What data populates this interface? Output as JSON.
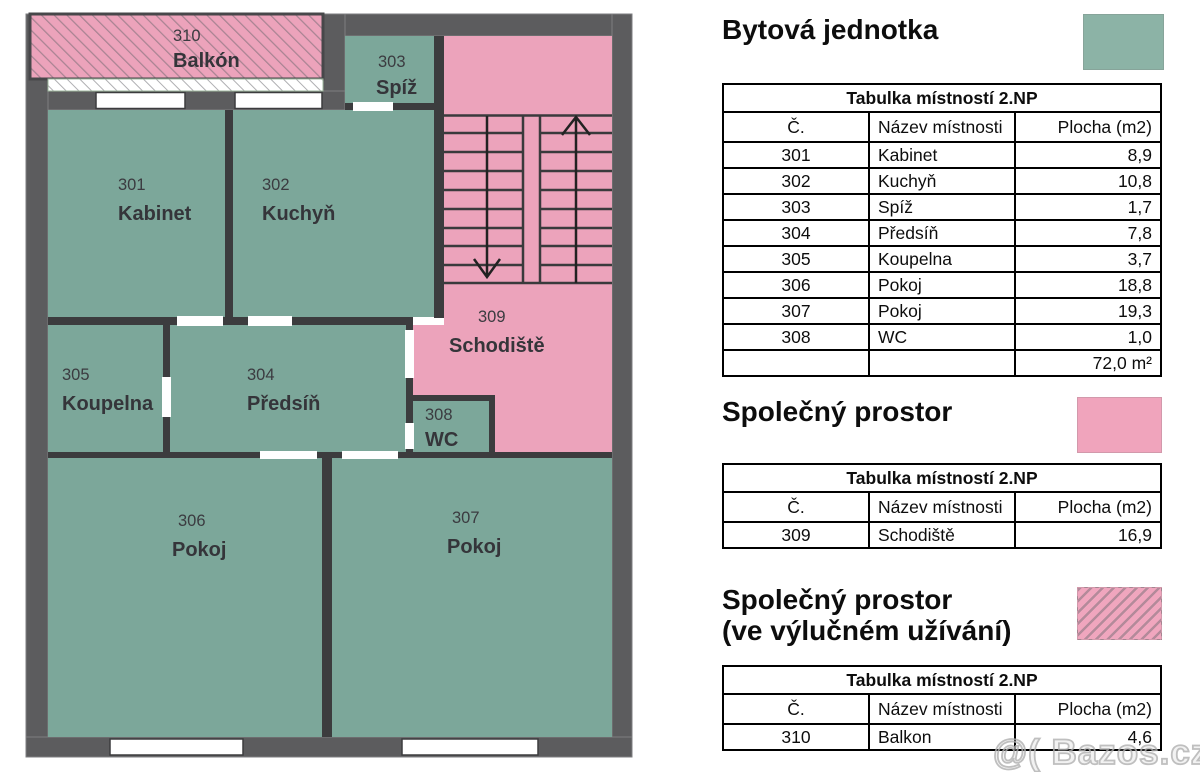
{
  "legend": [
    {
      "title": "Bytová jednotka",
      "subtitle": ""
    },
    {
      "title": "Společný prostor",
      "subtitle": ""
    },
    {
      "title": "Společný prostor",
      "subtitle": "(ve výlučném užívání)"
    }
  ],
  "tables": [
    {
      "title": "Tabulka místností 2.NP",
      "col_no": "Č.",
      "col_name": "Název místnosti",
      "col_area": "Plocha (m2)",
      "rows": [
        [
          "301",
          "Kabinet",
          "8,9"
        ],
        [
          "302",
          "Kuchyň",
          "10,8"
        ],
        [
          "303",
          "Spíž",
          "1,7"
        ],
        [
          "304",
          "Předsíň",
          "7,8"
        ],
        [
          "305",
          "Koupelna",
          "3,7"
        ],
        [
          "306",
          "Pokoj",
          "18,8"
        ],
        [
          "307",
          "Pokoj",
          "19,3"
        ],
        [
          "308",
          "WC",
          "1,0"
        ]
      ],
      "total": "72,0 m²"
    },
    {
      "title": "Tabulka místností 2.NP",
      "col_no": "Č.",
      "col_name": "Název místnosti",
      "col_area": "Plocha (m2)",
      "rows": [
        [
          "309",
          "Schodiště",
          "16,9"
        ]
      ]
    },
    {
      "title": "Tabulka místností 2.NP",
      "col_no": "Č.",
      "col_name": "Název místnosti",
      "col_area": "Plocha (m2)",
      "rows": [
        [
          "310",
          "Balkon",
          "4,6"
        ]
      ]
    }
  ],
  "plan": {
    "floor": "2.NP",
    "labels": {
      "balkon": {
        "num": "310",
        "name": "Balkón"
      },
      "spiz": {
        "num": "303",
        "name": "Spíž"
      },
      "kabinet": {
        "num": "301",
        "name": "Kabinet"
      },
      "kuchyn": {
        "num": "302",
        "name": "Kuchyň"
      },
      "schodiste": {
        "num": "309",
        "name": "Schodiště"
      },
      "koupelna": {
        "num": "305",
        "name": "Koupelna"
      },
      "predsin": {
        "num": "304",
        "name": "Předsíň"
      },
      "wc": {
        "num": "308",
        "name": "WC"
      },
      "pokoj306": {
        "num": "306",
        "name": "Pokoj"
      },
      "pokoj307": {
        "num": "307",
        "name": "Pokoj"
      }
    }
  },
  "colors": {
    "unit_green": "#7ca79a",
    "legend_green": "#8cb3a6",
    "common_pink": "#eca3bb",
    "legend_pink": "#f0a4bc",
    "outer_wall": "#5c5c5e",
    "inner_wall": "#3c3c3e"
  },
  "watermark": "@( Bazos.cz"
}
